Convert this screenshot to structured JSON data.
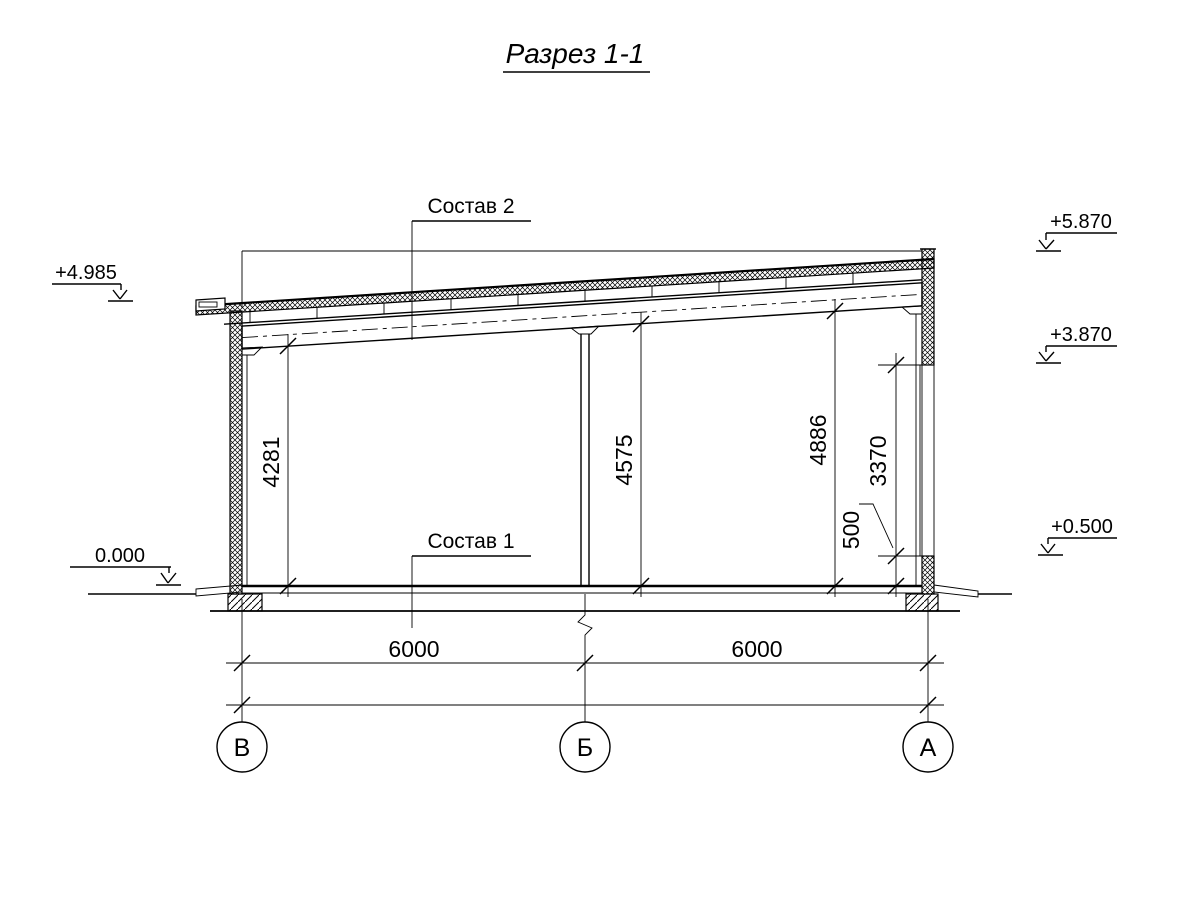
{
  "title": {
    "text": "Разрез 1-1"
  },
  "callouts": {
    "roof_composition": "Состав 2",
    "floor_composition": "Состав 1"
  },
  "elevations": {
    "left_wall_top": "+4.985",
    "ground_zero": "0.000",
    "parapet_top": "+5.870",
    "window_head": "+3.870",
    "plinth_top": "+0.500"
  },
  "dimensions": {
    "clear_height_left": "4281",
    "clear_height_middle": "4575",
    "clear_height_right": "4886",
    "window_height": "3370",
    "plinth_height": "500",
    "bay_left": "6000",
    "bay_right": "6000",
    "total_span": "12000"
  },
  "axes": {
    "left": "В",
    "middle": "Б",
    "right": "А"
  },
  "colors": {
    "line": "#000000",
    "background": "#ffffff"
  }
}
